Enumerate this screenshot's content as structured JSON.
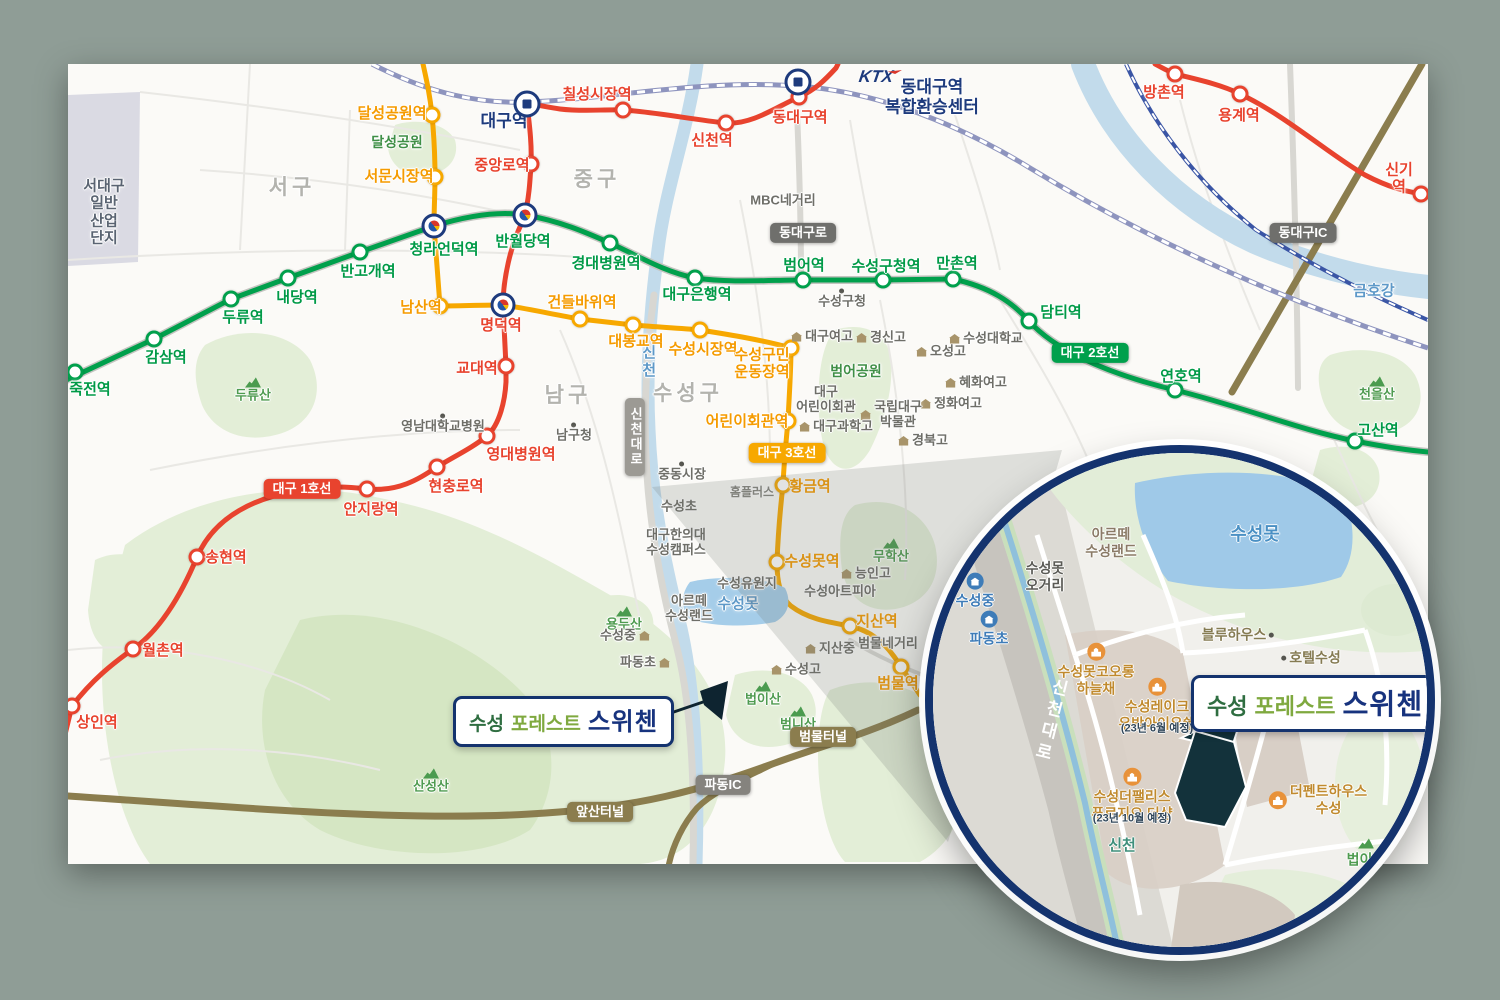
{
  "project": {
    "name_part1": "수성",
    "name_part2": "포레스트",
    "name_part3": "스위첸"
  },
  "ktx": {
    "label": "KTX"
  },
  "colors": {
    "background": "#8F9D96",
    "map_bg": "#FBFAF7",
    "line1_red": "#E8432E",
    "line2_green": "#00A04C",
    "line3_orange": "#F7A800",
    "park_green": "#E3EED7",
    "park_green_dark": "#D5E6C3",
    "water_blue": "#C2DBEB",
    "lake_blue": "#9FC9E8",
    "rail_slate": "#8E94BE",
    "rail_blue": "#3A55A5",
    "road_olive": "#8B7D4E",
    "navy": "#14336E",
    "site_dark": "#13323B",
    "industrial_gray": "#DADAE3"
  },
  "lines": [
    {
      "id": "line1",
      "name": "대구 1호선",
      "color": "#E8432E",
      "label_color": "#E8432E",
      "stations": [
        {
          "n": "상인역",
          "x": 72,
          "y": 706,
          "lx": 97,
          "ly": 723
        },
        {
          "n": "월촌역",
          "x": 133,
          "y": 649,
          "lx": 163,
          "ly": 651
        },
        {
          "n": "송현역",
          "x": 197,
          "y": 557,
          "lx": 226,
          "ly": 558
        },
        {
          "n": "안지랑역",
          "x": 367,
          "y": 489,
          "lx": 371,
          "ly": 510
        },
        {
          "n": "현충로역",
          "x": 437,
          "y": 467,
          "lx": 456,
          "ly": 487
        },
        {
          "n": "영대병원역",
          "x": 487,
          "y": 436,
          "lx": 521,
          "ly": 455
        },
        {
          "n": "교대역",
          "x": 506,
          "y": 366,
          "lx": 477,
          "ly": 369
        },
        {
          "n": "명덕역",
          "type": "label",
          "lx": 501,
          "ly": 326
        },
        {
          "n": "중앙로역",
          "x": 531,
          "y": 164,
          "lx": 502,
          "ly": 166
        },
        {
          "n": "대구역",
          "type": "label",
          "lx": 504,
          "ly": 122,
          "c": "#1E3B7D",
          "big": true
        },
        {
          "n": "칠성시장역",
          "x": 623,
          "y": 110,
          "lx": 597,
          "ly": 95
        },
        {
          "n": "신천역",
          "x": 726,
          "y": 123,
          "lx": 712,
          "ly": 141
        },
        {
          "n": "동대구역",
          "x": 799,
          "y": 97,
          "lx": 800,
          "ly": 118
        },
        {
          "n": "방촌역",
          "x": 1175,
          "y": 74,
          "lx": 1164,
          "ly": 93
        },
        {
          "n": "용계역",
          "x": 1240,
          "y": 94,
          "lx": 1239,
          "ly": 116
        },
        {
          "n": "신기역",
          "x": 1421,
          "y": 194,
          "lx": 1399,
          "ly": 179
        }
      ]
    },
    {
      "id": "line2",
      "name": "대구 2호선",
      "color": "#00A04C",
      "label_color": "#009A47",
      "stations": [
        {
          "n": "죽전역",
          "x": 75,
          "y": 372,
          "lx": 90,
          "ly": 390
        },
        {
          "n": "감삼역",
          "x": 154,
          "y": 339,
          "lx": 166,
          "ly": 358
        },
        {
          "n": "두류역",
          "x": 231,
          "y": 299,
          "lx": 243,
          "ly": 318
        },
        {
          "n": "내당역",
          "x": 288,
          "y": 278,
          "lx": 297,
          "ly": 298
        },
        {
          "n": "반고개역",
          "x": 360,
          "y": 252,
          "lx": 368,
          "ly": 272
        },
        {
          "n": "청라언덕역",
          "type": "label",
          "lx": 444,
          "ly": 250
        },
        {
          "n": "반월당역",
          "type": "label",
          "lx": 523,
          "ly": 242
        },
        {
          "n": "경대병원역",
          "x": 610,
          "y": 243,
          "lx": 606,
          "ly": 264
        },
        {
          "n": "대구은행역",
          "x": 695,
          "y": 278,
          "lx": 697,
          "ly": 295
        },
        {
          "n": "범어역",
          "x": 803,
          "y": 280,
          "lx": 804,
          "ly": 266
        },
        {
          "n": "수성구청역",
          "x": 883,
          "y": 280,
          "lx": 886,
          "ly": 267
        },
        {
          "n": "만촌역",
          "x": 953,
          "y": 279,
          "lx": 957,
          "ly": 264
        },
        {
          "n": "담티역",
          "x": 1029,
          "y": 321,
          "lx": 1061,
          "ly": 313
        },
        {
          "n": "연호역",
          "x": 1175,
          "y": 390,
          "lx": 1181,
          "ly": 377
        },
        {
          "n": "고산역",
          "x": 1355,
          "y": 441,
          "lx": 1378,
          "ly": 431
        }
      ]
    },
    {
      "id": "line3",
      "name": "대구 3호선",
      "color": "#F7A800",
      "label_color": "#F59B00",
      "stations": [
        {
          "n": "달성공원역",
          "x": 432,
          "y": 115,
          "lx": 392,
          "ly": 114
        },
        {
          "n": "서문시장역",
          "x": 435,
          "y": 177,
          "lx": 399,
          "ly": 177
        },
        {
          "n": "남산역",
          "x": 440,
          "y": 306,
          "lx": 421,
          "ly": 308
        },
        {
          "n": "건들바위역",
          "x": 580,
          "y": 319,
          "lx": 582,
          "ly": 303
        },
        {
          "n": "대봉교역",
          "x": 633,
          "y": 325,
          "lx": 636,
          "ly": 342
        },
        {
          "n": "수성시장역",
          "x": 700,
          "y": 330,
          "lx": 703,
          "ly": 350
        },
        {
          "n": "수성구민\n운동장역",
          "x": 791,
          "y": 348,
          "lx": 762,
          "ly": 364
        },
        {
          "n": "어린이회관역",
          "x": 788,
          "y": 421,
          "lx": 747,
          "ly": 422
        },
        {
          "n": "황금역",
          "x": 783,
          "y": 485,
          "lx": 810,
          "ly": 487
        },
        {
          "n": "수성못역",
          "x": 777,
          "y": 562,
          "lx": 812,
          "ly": 562
        },
        {
          "n": "지산역",
          "x": 850,
          "y": 626,
          "lx": 877,
          "ly": 622
        },
        {
          "n": "범물역",
          "x": 901,
          "y": 667,
          "lx": 898,
          "ly": 684
        }
      ]
    }
  ],
  "transfers": [
    {
      "x": 434,
      "y": 226
    },
    {
      "x": 525,
      "y": 215
    },
    {
      "x": 503,
      "y": 305
    }
  ],
  "train_icons": [
    {
      "x": 527,
      "y": 104
    },
    {
      "x": 798,
      "y": 82
    }
  ],
  "badges": [
    {
      "t": "동대구로",
      "x": 803,
      "y": 233,
      "cls": "road-gray"
    },
    {
      "t": "동대구IC",
      "x": 1303,
      "y": 233,
      "cls": "road-gray"
    },
    {
      "t": "대구 2호선",
      "x": 1090,
      "y": 353,
      "cls": "line2"
    },
    {
      "t": "대구 1호선",
      "x": 302,
      "y": 489,
      "cls": "line1"
    },
    {
      "t": "대구 3호선",
      "x": 787,
      "y": 453,
      "cls": "line3"
    },
    {
      "t": "신천대로",
      "x": 635,
      "y": 437,
      "cls": "vertical"
    },
    {
      "t": "범물터널",
      "x": 823,
      "y": 737,
      "cls": "road-olive"
    },
    {
      "t": "앞산터널",
      "x": 600,
      "y": 812,
      "cls": "road-olive"
    },
    {
      "t": "파동IC",
      "x": 723,
      "y": 785,
      "cls": "road-gray2"
    }
  ],
  "map_labels": [
    {
      "t": "서대구\n일반\n산업\n단지",
      "x": 104,
      "y": 212,
      "cls": "c-industrial"
    },
    {
      "t": "서구",
      "x": 292,
      "y": 188,
      "cls": "c-district"
    },
    {
      "t": "중구",
      "x": 597,
      "y": 180,
      "cls": "c-district"
    },
    {
      "t": "남구",
      "x": 568,
      "y": 396,
      "cls": "c-district"
    },
    {
      "t": "수성구",
      "x": 688,
      "y": 394,
      "cls": "c-district"
    },
    {
      "t": "달성공원",
      "x": 397,
      "y": 142,
      "cls": "c-greenb"
    },
    {
      "t": "두류산",
      "x": 253,
      "y": 390,
      "cls": "c-green",
      "icon": "mountain",
      "pos": "above"
    },
    {
      "t": "영남대학교병원",
      "x": 443,
      "y": 424,
      "cls": "c-poi",
      "icon": "dot",
      "pos": "above"
    },
    {
      "t": "남구청",
      "x": 574,
      "y": 433,
      "cls": "c-poi",
      "icon": "dot",
      "pos": "above"
    },
    {
      "t": "중동시장",
      "x": 682,
      "y": 472,
      "cls": "c-poi",
      "icon": "dot",
      "pos": "above"
    },
    {
      "t": "수성초",
      "x": 679,
      "y": 507,
      "cls": "c-poi"
    },
    {
      "t": "대구한의대\n수성캠퍼스",
      "x": 676,
      "y": 543,
      "cls": "c-poi"
    },
    {
      "t": "홈플러스",
      "x": 752,
      "y": 493,
      "cls": "c-poi-sm"
    },
    {
      "t": "MBC네거리",
      "x": 783,
      "y": 201,
      "cls": "c-poi"
    },
    {
      "t": "수성구청",
      "x": 842,
      "y": 299,
      "cls": "c-poi",
      "icon": "dot",
      "pos": "above"
    },
    {
      "t": "대구여고",
      "x": 822,
      "y": 337,
      "cls": "c-poi",
      "icon": "school",
      "pos": "left"
    },
    {
      "t": "경신고",
      "x": 881,
      "y": 338,
      "cls": "c-poi",
      "icon": "school",
      "pos": "left"
    },
    {
      "t": "오성고",
      "x": 941,
      "y": 352,
      "cls": "c-poi",
      "icon": "school",
      "pos": "left"
    },
    {
      "t": "수성대학교",
      "x": 986,
      "y": 339,
      "cls": "c-poi",
      "icon": "school",
      "pos": "left"
    },
    {
      "t": "혜화여고",
      "x": 976,
      "y": 383,
      "cls": "c-poi",
      "icon": "school",
      "pos": "left"
    },
    {
      "t": "정화여고",
      "x": 951,
      "y": 404,
      "cls": "c-poi",
      "icon": "school",
      "pos": "left"
    },
    {
      "t": "국립대구\n박물관",
      "x": 891,
      "y": 415,
      "cls": "c-poi",
      "icon": "school",
      "pos": "left"
    },
    {
      "t": "경북고",
      "x": 923,
      "y": 441,
      "cls": "c-poi",
      "icon": "school",
      "pos": "left"
    },
    {
      "t": "대구과학고",
      "x": 836,
      "y": 427,
      "cls": "c-poi",
      "icon": "school",
      "pos": "left"
    },
    {
      "t": "대구\n어린이회관",
      "x": 826,
      "y": 400,
      "cls": "c-poi"
    },
    {
      "t": "범어공원",
      "x": 856,
      "y": 371,
      "cls": "c-greenb"
    },
    {
      "t": "무학산",
      "x": 891,
      "y": 551,
      "cls": "c-green",
      "icon": "mountain",
      "pos": "above"
    },
    {
      "t": "능인고",
      "x": 866,
      "y": 574,
      "cls": "c-poi",
      "icon": "school",
      "pos": "left"
    },
    {
      "t": "수성아트피아",
      "x": 840,
      "y": 592,
      "cls": "c-poi"
    },
    {
      "t": "수성유원지",
      "x": 747,
      "y": 584,
      "cls": "c-poi"
    },
    {
      "t": "아르떼\n수성랜드",
      "x": 689,
      "y": 609,
      "cls": "c-poi"
    },
    {
      "t": "수성못",
      "x": 738,
      "y": 604,
      "cls": "c-water"
    },
    {
      "t": "용두산",
      "x": 624,
      "y": 619,
      "cls": "c-green",
      "icon": "mountain",
      "pos": "above"
    },
    {
      "t": "수성중",
      "x": 625,
      "y": 636,
      "cls": "c-poi",
      "icon": "school",
      "pos": "right"
    },
    {
      "t": "파동초",
      "x": 645,
      "y": 663,
      "cls": "c-poi",
      "icon": "school",
      "pos": "right"
    },
    {
      "t": "지산중",
      "x": 830,
      "y": 649,
      "cls": "c-poi",
      "icon": "school",
      "pos": "left"
    },
    {
      "t": "범물네거리",
      "x": 888,
      "y": 644,
      "cls": "c-poi"
    },
    {
      "t": "수성고",
      "x": 796,
      "y": 670,
      "cls": "c-poi",
      "icon": "school",
      "pos": "left"
    },
    {
      "t": "법이산",
      "x": 763,
      "y": 694,
      "cls": "c-green",
      "icon": "mountain",
      "pos": "above"
    },
    {
      "t": "범니산",
      "x": 798,
      "y": 719,
      "cls": "c-green",
      "icon": "mountain",
      "pos": "above"
    },
    {
      "t": "산성산",
      "x": 431,
      "y": 781,
      "cls": "c-green",
      "icon": "mountain",
      "pos": "above"
    },
    {
      "t": "천을산",
      "x": 1377,
      "y": 389,
      "cls": "c-green",
      "icon": "mountain",
      "pos": "above"
    },
    {
      "t": "금호강",
      "x": 1374,
      "y": 291,
      "cls": "c-water"
    },
    {
      "t": "신천",
      "x": 648,
      "y": 362,
      "cls": "c-water vertical-text"
    },
    {
      "t": "동대구역\n복합환승센터",
      "x": 932,
      "y": 97,
      "cls": "c-navy c-big"
    }
  ],
  "inset": {
    "labels": [
      {
        "t": "수성못",
        "x": 322,
        "y": 82,
        "cls": "i-water"
      },
      {
        "t": "아르떼\n수성랜드",
        "x": 178,
        "y": 90,
        "cls": "i-brown"
      },
      {
        "t": "수성못\n오거리",
        "x": 112,
        "y": 124,
        "cls": "i-dark"
      },
      {
        "t": "수성중",
        "x": 42,
        "y": 138,
        "cls": "i-blue",
        "icon": "bschool",
        "pos": "above"
      },
      {
        "t": "파동초",
        "x": 56,
        "y": 176,
        "cls": "i-blue",
        "icon": "bschool",
        "pos": "above"
      },
      {
        "t": "블루하우스",
        "x": 305,
        "y": 182,
        "cls": "i-olive",
        "icon": "dot",
        "pos": "right"
      },
      {
        "t": "호텔수성",
        "x": 378,
        "y": 205,
        "cls": "i-olive",
        "icon": "dot",
        "pos": "left"
      },
      {
        "t": "수성못코오롱\n하늘채",
        "x": 163,
        "y": 217,
        "cls": "i-orange",
        "icon": "apt",
        "pos": "above"
      },
      {
        "t": "수성레이크\n우방아이유쉘",
        "x": 224,
        "y": 252,
        "cls": "i-orange",
        "icon": "apt",
        "pos": "above"
      },
      {
        "t": "(23년 6월 예정)",
        "x": 224,
        "y": 276,
        "cls": "i-note"
      },
      {
        "t": "수성더팰리스\n푸르지오 더샵",
        "x": 199,
        "y": 342,
        "cls": "i-orange",
        "icon": "apt",
        "pos": "above"
      },
      {
        "t": "(23년 10월 예정)",
        "x": 199,
        "y": 366,
        "cls": "i-note"
      },
      {
        "t": "더펜트하우스\n수성",
        "x": 385,
        "y": 347,
        "cls": "i-orange",
        "icon": "apt",
        "pos": "left"
      },
      {
        "t": "신천",
        "x": 189,
        "y": 393,
        "cls": "i-teal"
      },
      {
        "t": "법이산",
        "x": 433,
        "y": 400,
        "cls": "i-green",
        "icon": "mountain",
        "pos": "above"
      },
      {
        "t": "수성고",
        "x": 500,
        "y": 283,
        "cls": "i-blue",
        "icon": "bschool",
        "pos": "above"
      },
      {
        "t": "신천대로",
        "x": 116,
        "y": 268,
        "cls": "i-road"
      }
    ]
  }
}
